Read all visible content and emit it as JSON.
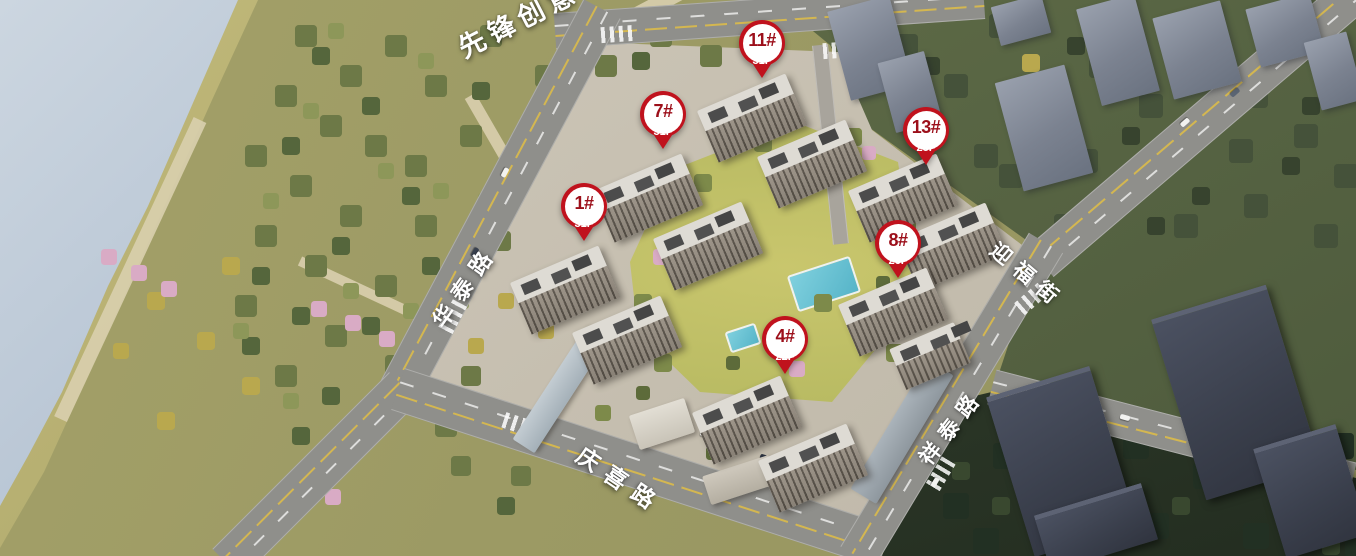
{
  "scene": {
    "description": "aerial rendering of residential development with building markers and road labels"
  },
  "markers": [
    {
      "label": "1#",
      "floors": "31F",
      "x": 584,
      "y": 206
    },
    {
      "label": "4#",
      "floors": "22F",
      "x": 785,
      "y": 339
    },
    {
      "label": "7#",
      "floors": "31F",
      "x": 663,
      "y": 114
    },
    {
      "label": "8#",
      "floors": "26F",
      "x": 898,
      "y": 243
    },
    {
      "label": "11#",
      "floors": "31F",
      "x": 762,
      "y": 43
    },
    {
      "label": "13#",
      "floors": "28F",
      "x": 926,
      "y": 130
    }
  ],
  "road_labels": [
    {
      "name": "华泰路",
      "x": 464,
      "y": 285,
      "rotate": -55,
      "size": 22,
      "spacing": 10
    },
    {
      "name": "迎福街",
      "x": 1028,
      "y": 275,
      "rotate": 40,
      "size": 21,
      "spacing": 9
    },
    {
      "name": "祥泰路",
      "x": 951,
      "y": 426,
      "rotate": -52,
      "size": 21,
      "spacing": 9
    },
    {
      "name": "庆喜路",
      "x": 621,
      "y": 479,
      "rotate": 34,
      "size": 23,
      "spacing": 10
    },
    {
      "name": "先锋创意",
      "x": 518,
      "y": 18,
      "rotate": -27,
      "size": 27,
      "spacing": 6
    }
  ],
  "colors": {
    "pin_red": "#c0121d",
    "pin_number_text": "#9c0f1a",
    "pin_floor_text": "#ffffff",
    "label_text": "#ffffff"
  }
}
